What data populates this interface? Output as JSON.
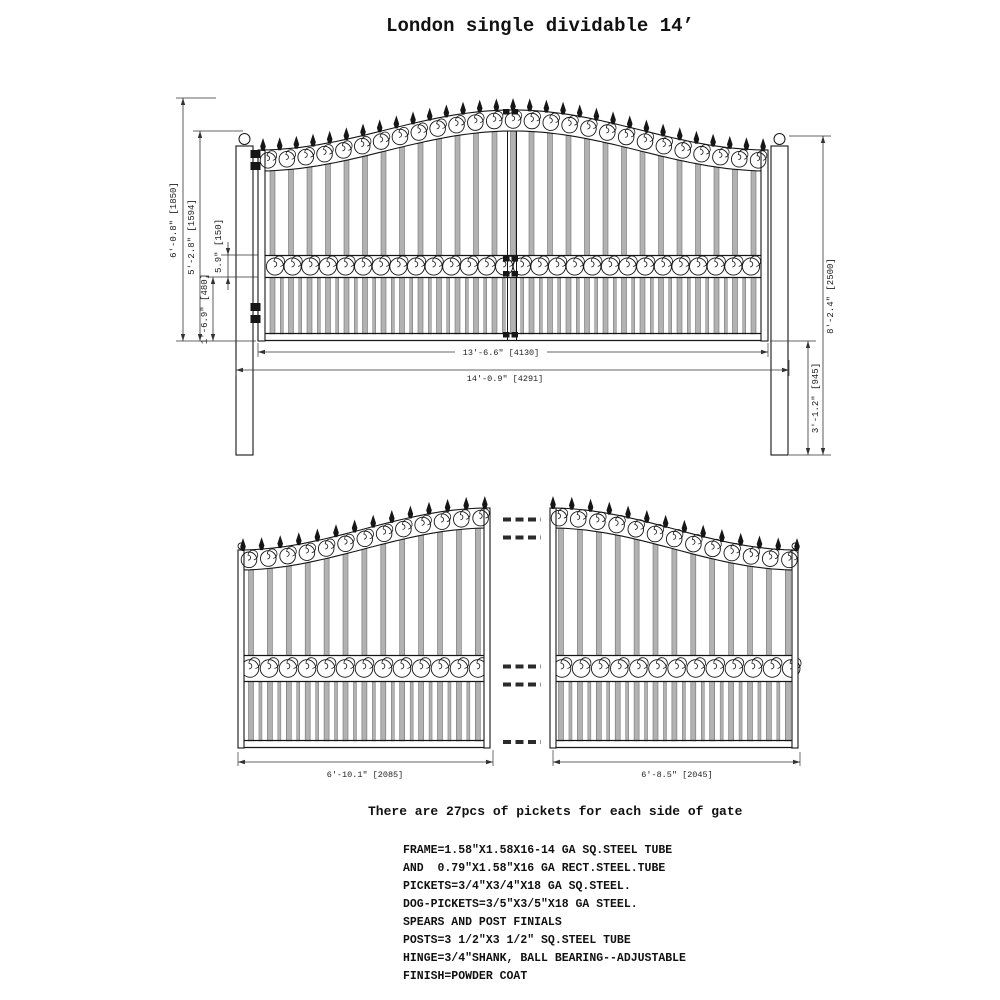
{
  "title": "London single dividable 14’",
  "top_view": {
    "dim_overall_height": "6'-0.8\" [1850]",
    "dim_frame_side_height": "5'-2.8\" [1594]",
    "dim_mid_band": "5.9\" [150]",
    "dim_bottom_section": "1'-6.9\" [480]",
    "dim_post_height": "8'-2.4\" [2500]",
    "dim_post_lower": "3'-1.2\" [945]",
    "dim_gate_width": "13'-6.6\" [4130]",
    "dim_overall_width": "14'-0.9\" [4291]"
  },
  "split_view": {
    "dim_left_leaf": "6'-10.1\" [2085]",
    "dim_right_leaf": "6'-8.5\" [2045]"
  },
  "notes": {
    "pickets_note": "There are 27pcs of pickets for each side of gate",
    "spec_lines": [
      "FRAME=1.58\"X1.58X16-14 GA SQ.STEEL TUBE",
      "AND  0.79\"X1.58\"X16 GA RECT.STEEL.TUBE",
      "PICKETS=3/4\"X3/4\"X18 GA SQ.STEEL.",
      "DOG-PICKETS=3/5\"X3/5\"X18 GA STEEL.",
      "SPEARS AND POST FINIALS",
      "POSTS=3 1/2\"X3 1/2\" SQ.STEEL TUBE",
      "HINGE=3/4\"SHANK, BALL BEARING--ADJUSTABLE",
      "FINISH=POWDER COAT"
    ]
  },
  "colors": {
    "line": "#161616",
    "picket": "#b2b2b2",
    "picket_edge": "#707070",
    "dim": "#333333",
    "text": "#111111"
  }
}
